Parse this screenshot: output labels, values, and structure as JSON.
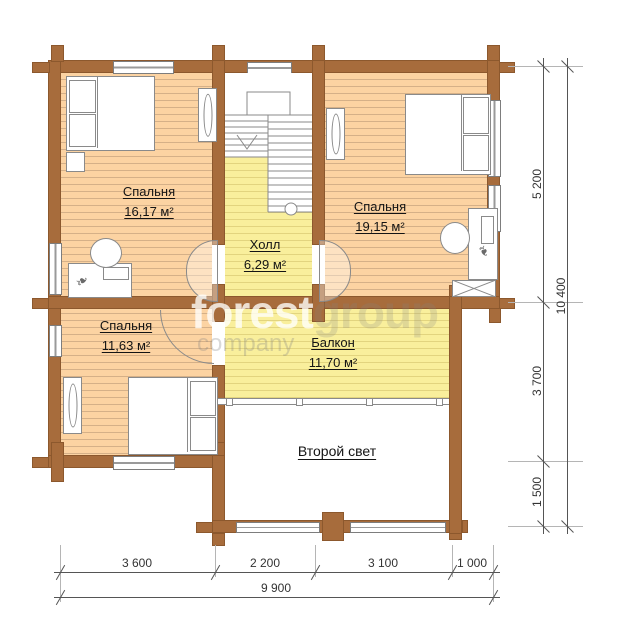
{
  "rooms": [
    {
      "name": "Спальня",
      "area": "16,17 м²"
    },
    {
      "name": "Спальня",
      "area": "19,15 м²"
    },
    {
      "name": "Спальня",
      "area": "11,63 м²"
    },
    {
      "name": "Холл",
      "area": "6,29 м²"
    },
    {
      "name": "Балкон",
      "area": "11,70 м²"
    }
  ],
  "second_light_label": "Второй свет",
  "dimensions": {
    "right_segments": [
      "5 200",
      "3 700",
      "1 500"
    ],
    "right_total": "10 400",
    "bottom_segments": [
      "3 600",
      "2 200",
      "3 100",
      "1 000"
    ],
    "bottom_total": "9 900"
  },
  "watermark": {
    "word1": "forest",
    "word2": "group",
    "word3": "company"
  },
  "colors": {
    "wall": "#a76c3c",
    "wood_floor": "#fcd3a2",
    "yellow_floor": "#f9ef9c"
  }
}
